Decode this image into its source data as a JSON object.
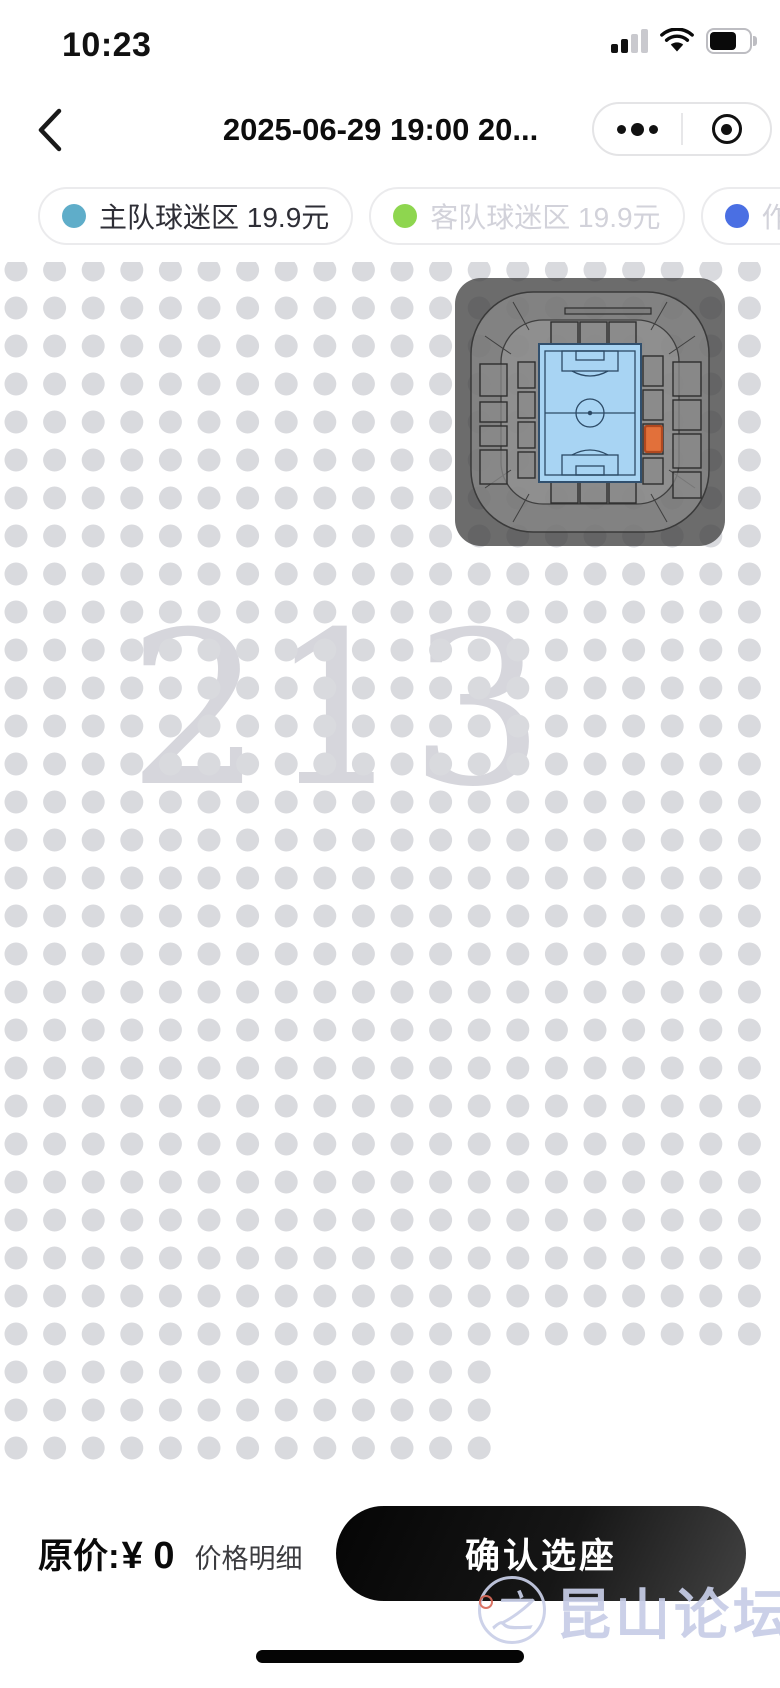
{
  "status_bar": {
    "time": "10:23"
  },
  "nav": {
    "title": "2025-06-29 19:00 20..."
  },
  "legend": [
    {
      "label": "主队球迷区 19.9元",
      "dot_color": "#5fadc9",
      "active": true
    },
    {
      "label": "客队球迷区 19.9元",
      "dot_color": "#8ed64f",
      "active": false
    },
    {
      "label": "作废",
      "dot_color": "#4a6fe3",
      "active": false
    }
  ],
  "seat_map": {
    "section_number": "213",
    "dot_color": "#d9dade",
    "grid": {
      "cols": 20,
      "rows": 32,
      "full_row_count": 29,
      "short_row_cols": 13,
      "pitch_x": 38.6,
      "pitch_y": 38,
      "offset_x": 16,
      "offset_y": 8,
      "dot_radius": 11.5
    }
  },
  "minimap": {
    "overlay_color": "rgba(66,66,66,0.78)",
    "bowl_color": "rgba(150,150,150,0.55)",
    "section_fill": "rgba(138,138,138,0.75)",
    "section_stroke": "#2e2e2e",
    "pitch_fill": "#a8d4f3",
    "pitch_line": "#2c4a66",
    "selected_fill": "#e2703a",
    "selected_stroke": "#b0481f"
  },
  "footer": {
    "price_prefix": "原价:",
    "price_value": "¥ 0",
    "detail_label": "价格明细",
    "confirm_label": "确认选座"
  },
  "watermark": {
    "text": "昆山论坛",
    "glyph": "之"
  }
}
